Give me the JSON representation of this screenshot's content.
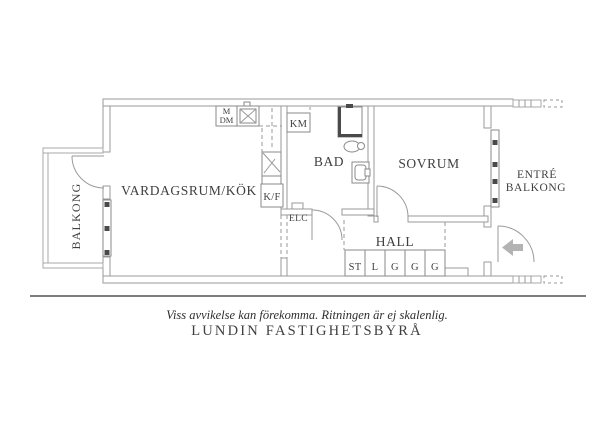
{
  "plan": {
    "rooms": {
      "living_kitchen": "VARDAGSRUM/KÖK",
      "bathroom": "BAD",
      "bedroom": "SOVRUM",
      "hall": "HALL",
      "balcony": "BALKONG",
      "entry_balcony": {
        "line1": "ENTRÉ",
        "line2": "BALKONG"
      }
    },
    "labels": {
      "fridge_freezer": "K/F",
      "washing_machine": "KM",
      "microwave": "M",
      "dishwasher": "DM",
      "electrical_cabinet": "ELC"
    },
    "closets": [
      "ST",
      "L",
      "G",
      "G",
      "G"
    ],
    "icons": {
      "entrance_arrow": "arrow-left"
    },
    "colors": {
      "wall_line": "#9a9a9a",
      "text": "#3f3f3f",
      "dark_fixture": "#4a4a4a",
      "entrance_arrow": "#b3b3b3"
    }
  },
  "footer": {
    "disclaimer": "Viss avvikelse kan förekomma. Ritningen är ej skalenlig.",
    "brand": "LUNDIN FASTIGHETSBYRÅ"
  }
}
